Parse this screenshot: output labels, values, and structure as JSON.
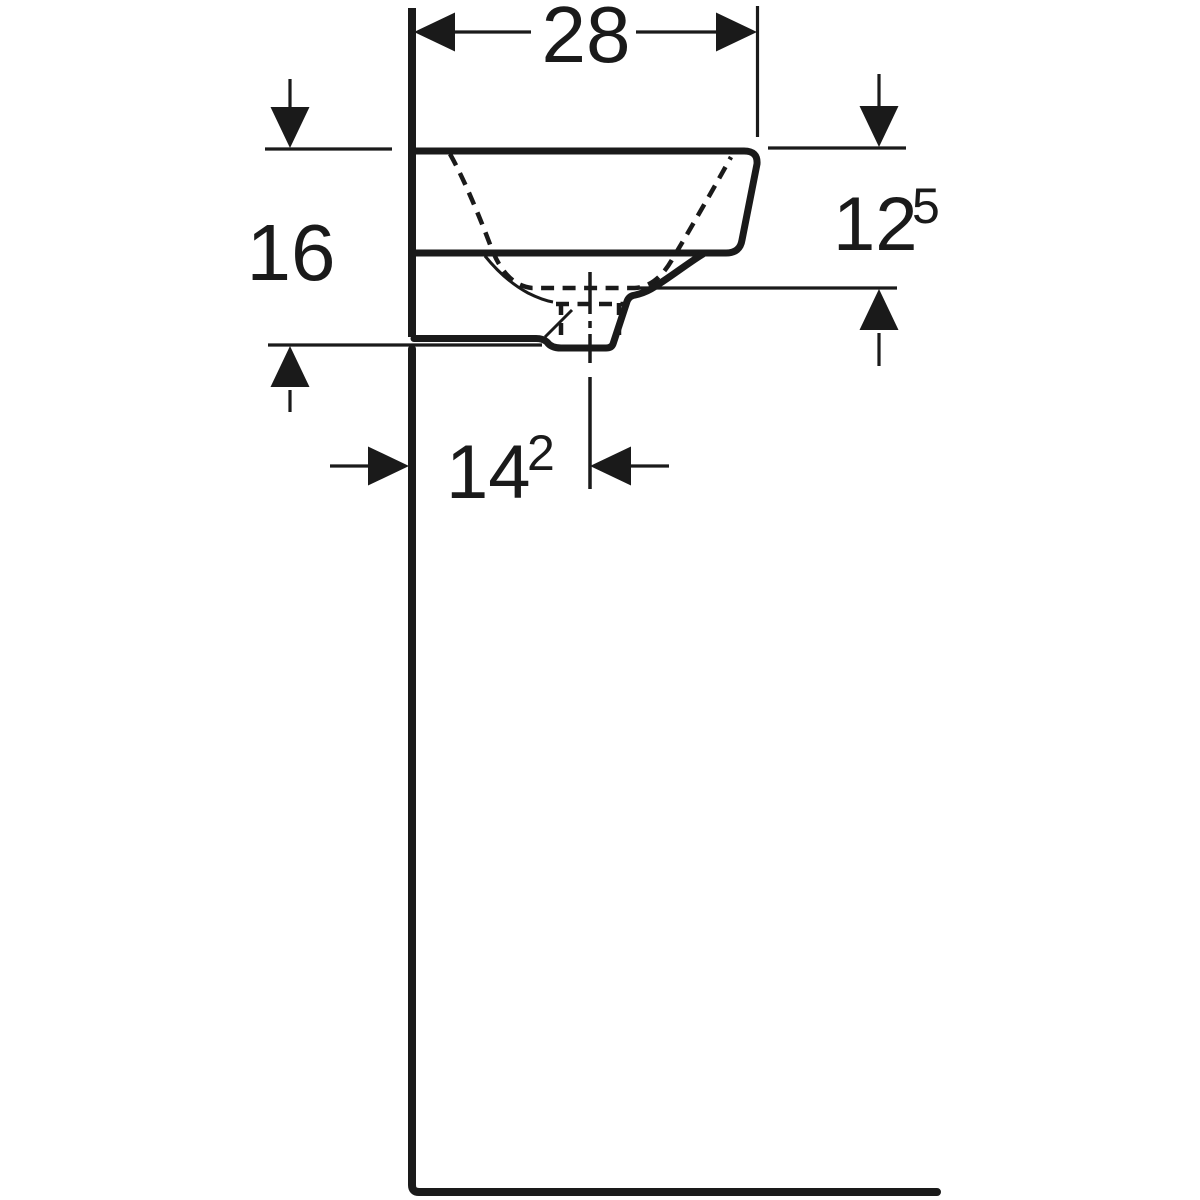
{
  "diagram": {
    "colors": {
      "ink": "#1a1a1a",
      "background": "#ffffff"
    },
    "dimensions": {
      "top_width": {
        "label": "28"
      },
      "left_height": {
        "label": "16"
      },
      "right_depth": {
        "label": "12",
        "superscript": "5"
      },
      "bottom_offset": {
        "label": "14",
        "superscript": "2"
      }
    }
  }
}
